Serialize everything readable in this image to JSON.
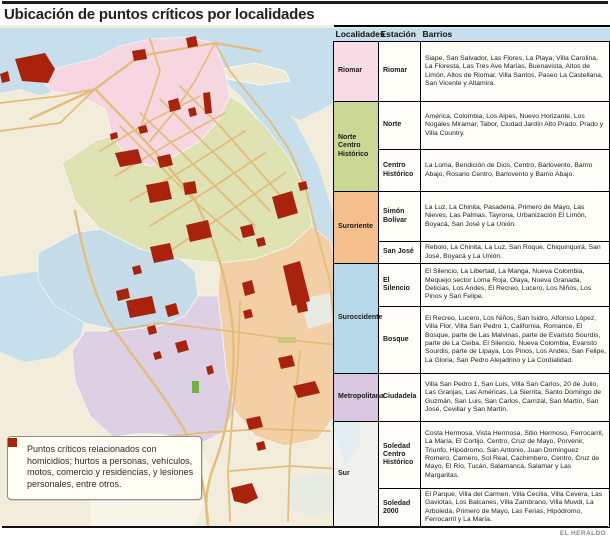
{
  "title": "Ubicación de puntos críticos por localidades",
  "credit": "EL HERALDO",
  "legend": {
    "text": "Puntos críticos relacionados con homicidios; hurtos a personas, vehículos, motos, comercio y residencias, y lesiones personales, entre otros.",
    "marker_color": "#a8220c"
  },
  "colors": {
    "critical_point_red": "#a8220c",
    "water_blue": "#c7dfec",
    "background_beige": "#f2ecdb",
    "road_tan": "#e7c384",
    "riomar_pink": "#f8dbe4",
    "norte_centro_historico_green": "#cbd795",
    "suroriente_orange": "#f4bf8d",
    "suroccidente_blue": "#b7d8e8",
    "metropolitana_purple": "#d9c6e0"
  },
  "table": {
    "headers": [
      "Localidades",
      "Estación",
      "Barrios"
    ],
    "groups": [
      {
        "localidad": "Riomar",
        "stations": [
          {
            "name": "Riomar",
            "barrios": "Siape, San Salvador, Las Flores, La Playa, Villa Carolina, La Floresta, Las Tres Ave Marías, Buenavista, Altos de Limón, Altos de Riomar, Villa Santos, Paseo La Castellana, San Vicente y Altamira."
          }
        ]
      },
      {
        "localidad": "Norte Centro Histórico",
        "stations": [
          {
            "name": "Norte",
            "barrios": "América, Colombia, Los Alpes, Nuevo Horizante, Los Nogales Miramar, Tabor, Ciudad Jardín Alto Prado, Prado y Villa Country."
          },
          {
            "name": "Centro Histórico",
            "barrios": "La Loma, Bendición de Dios, Centro, Barlovento, Barrio Abajo, Rosario Centro, Barlovento y Barrio Abajo."
          }
        ]
      },
      {
        "localidad": "Suroriente",
        "stations": [
          {
            "name": "Simón Bolívar",
            "barrios": "La Luz, La Chinita, Pasadena, Primero de Mayo, Las Nieves, Las Palmas, Tayrona, Urbanización El Limón, Boyacá, San José y La Unión."
          },
          {
            "name": "San José",
            "barrios": "Rebolo, La Chinita, La Luz, San Roque, Chiquinquirá, San José, Boyacá y La Unión."
          }
        ]
      },
      {
        "localidad": "Suroccidente",
        "stations": [
          {
            "name": "El Silencio",
            "barrios": "El Silencio, La Libertad, La Manga, Nueva Colombia, Mequejo sector Loma Roja, Olaya, Nueva Granada, Delicias, Los Andes, El Recreo, Lucero, Los Niños, Los Pinos y San Felipe."
          },
          {
            "name": "Bosque",
            "barrios": "El Recreo, Lucero, Los Niños, San Isidro, Alfonso López, Villa Flor, Villa San Pedro 1, California, Romance, El Bosque, parte de Las Malvinas, parte de Evaristo Sourdis, parte de La Ceiba, El Silencio, Nueva Colombia, Evaristo Sourdis, parte de Lipaya, Los Pinos, Los Andes, San Felipe, La Gloria, San Pedro Alejadrino y La Cordialidad."
          }
        ]
      },
      {
        "localidad": "Metropolitana",
        "stations": [
          {
            "name": "Ciudadela",
            "barrios": "Villa San Pedro 1, San Luis, Villa San Carlos, 20 de Julio, Las Granjas, Las Américas, La Sierrita, Santo Domingo de Guzmán, San Luis, San Carlos, Carrizal, San Martín, San José, Cevillar y San Martín."
          }
        ]
      },
      {
        "localidad": "Sur",
        "stations": [
          {
            "name": "Soledad Centro Histórico",
            "barrios": "Costa Hermosa, Vista Hermosa, Sitio Hermoso, Ferrocarril, La María, El Cortijo, Centro, Cruz de Mayo, Porvenir, Triunfo, Hipódromo, San Antonio, Juan Domínguez Romero, Carnero, Sol Real, Cachimbero, Centro, Cruz de Mayo, El Río, Tucán, Salamanca, Salamar y Las Margaritas."
          },
          {
            "name": "Soledad 2000",
            "barrios": "El Parque, Villa del Carmen, Villa Cecilia, Villa Cevera, Las Gaviotas, Los Balcanes, Villa Zambrano, Villa Muvdi, La Arboleda, Primero de Mayo, Las Ferias, Hipódromo, Ferrocarril y La María."
          }
        ]
      }
    ]
  }
}
